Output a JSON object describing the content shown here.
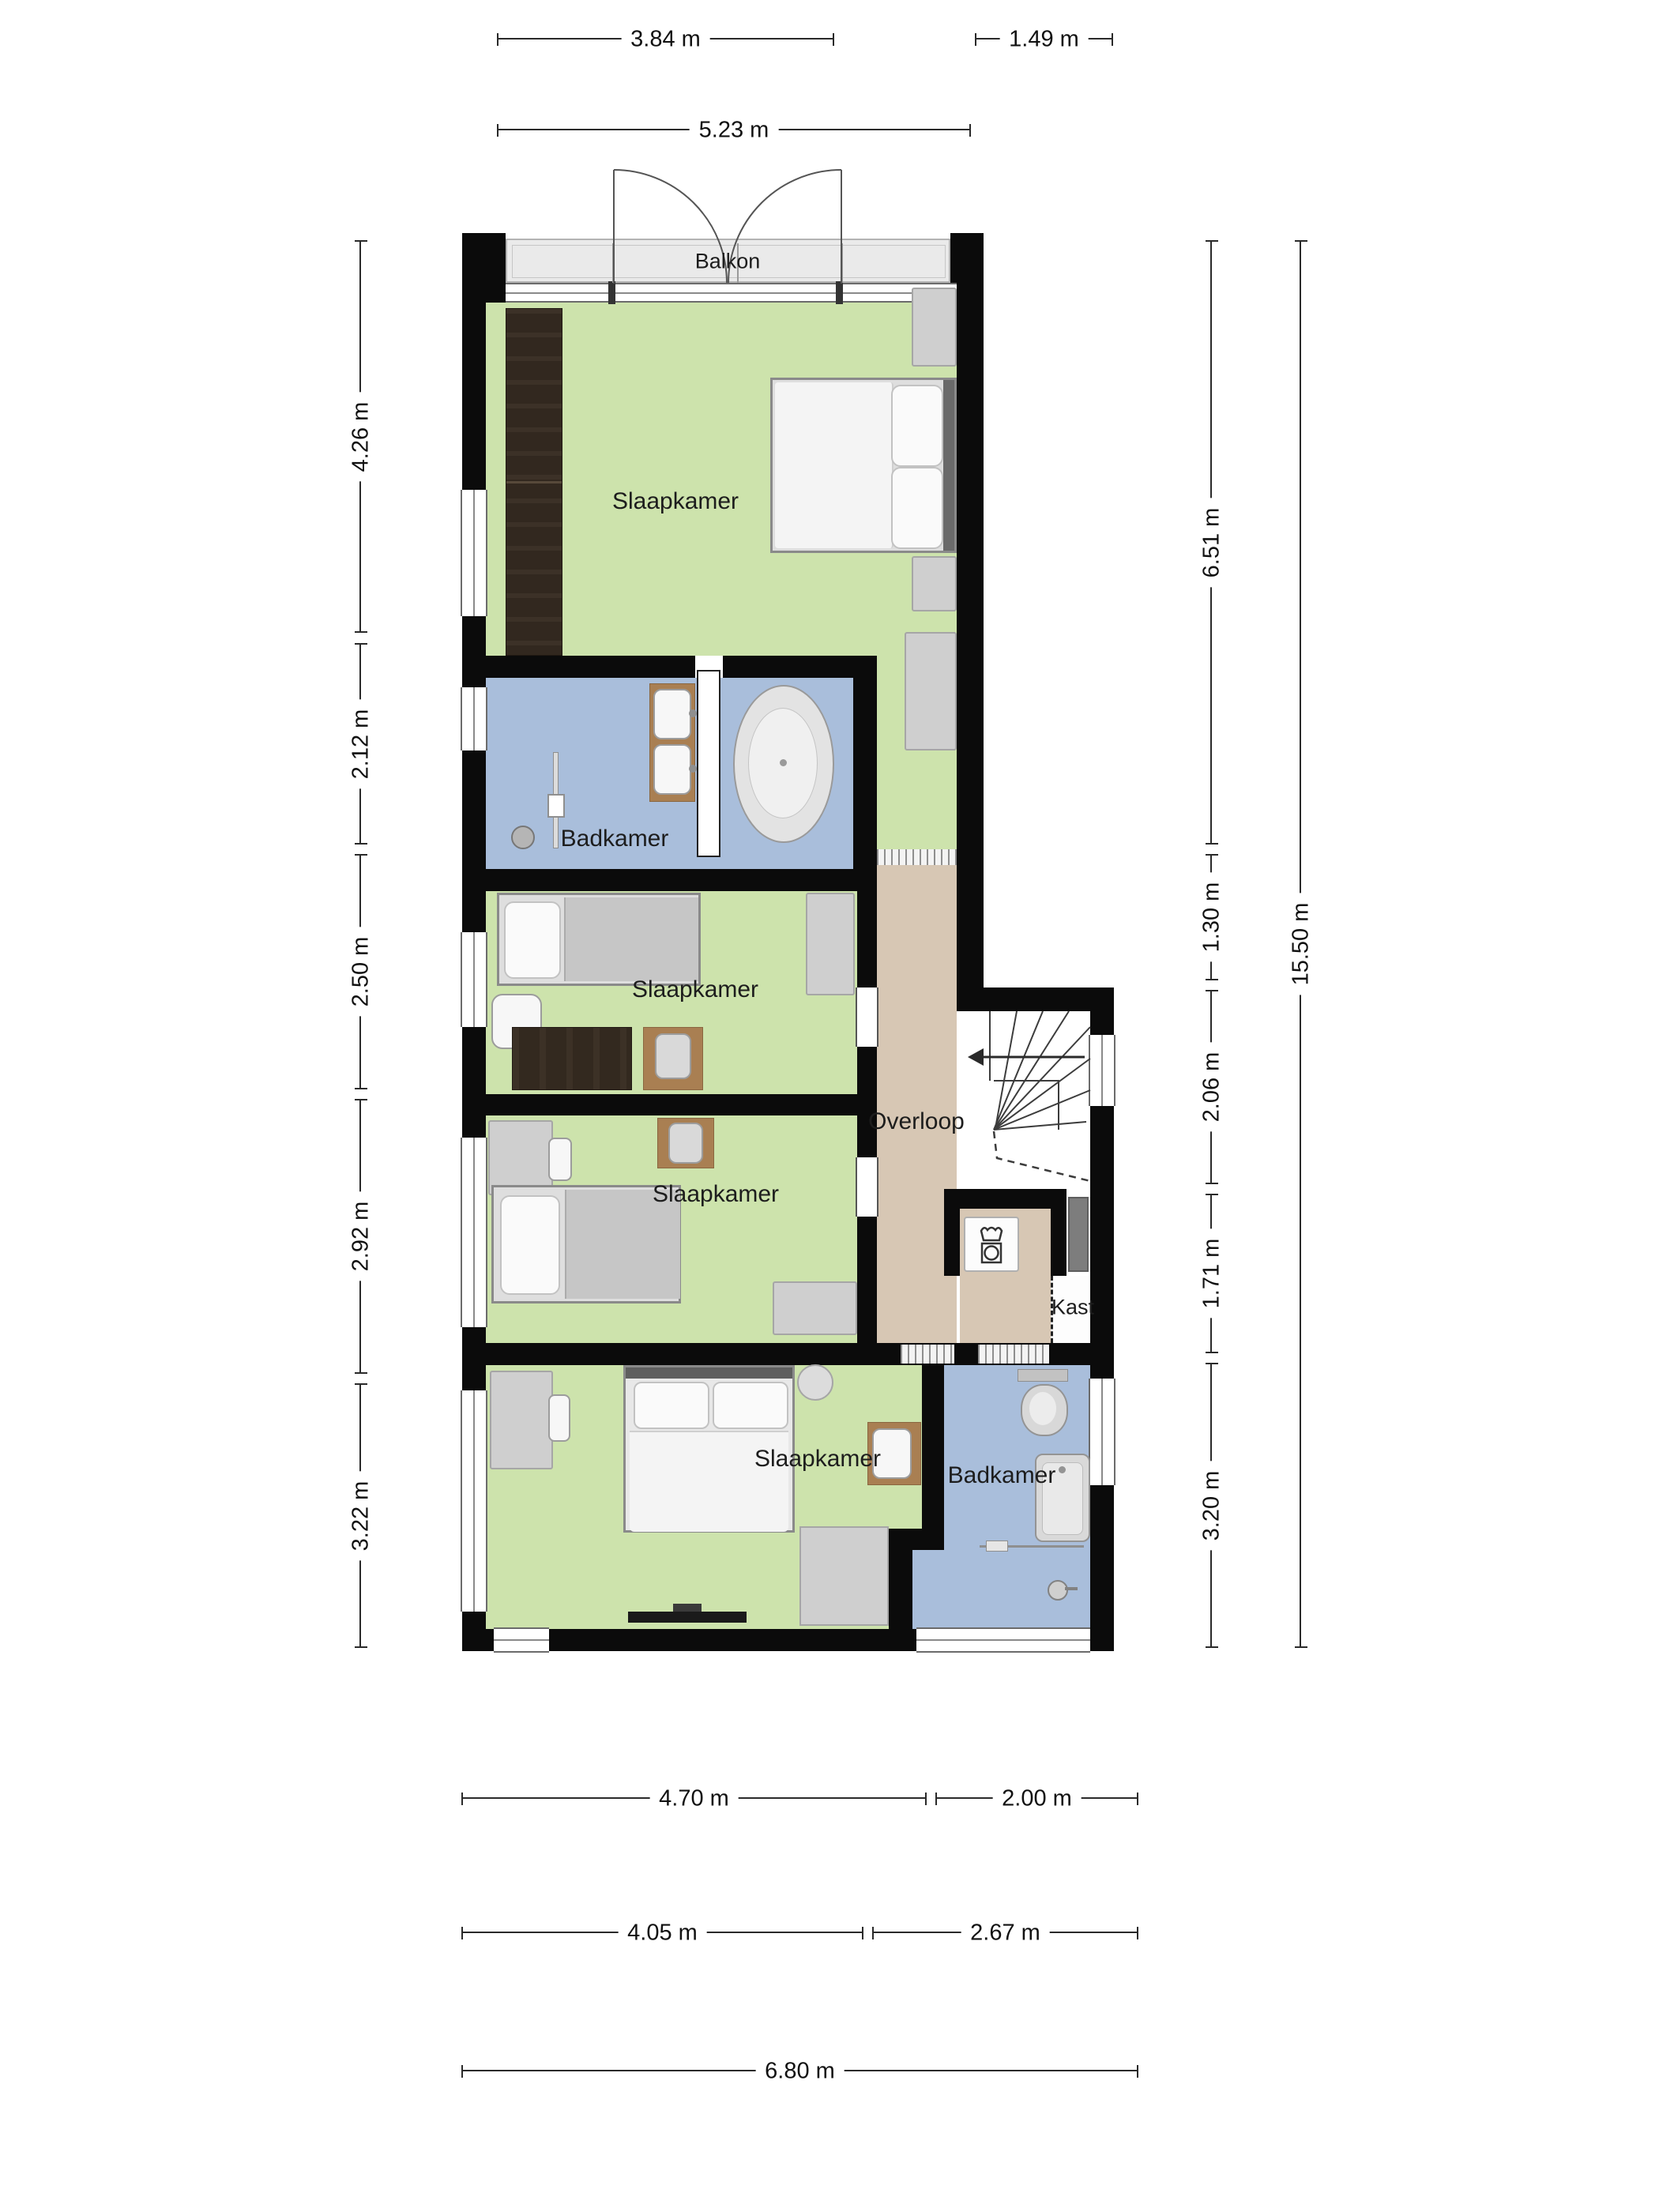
{
  "plan_type": "floor-plan",
  "labels": {
    "balkon": "Balkon",
    "slaapkamer_1": "Slaapkamer",
    "badkamer_1": "Badkamer",
    "slaapkamer_2": "Slaapkamer",
    "slaapkamer_3": "Slaapkamer",
    "slaapkamer_4": "Slaapkamer",
    "badkamer_2": "Badkamer",
    "overloop": "Overloop",
    "kast": "Kast"
  },
  "dimensions": {
    "top_row_1": [
      "3.84 m",
      "1.49 m"
    ],
    "top_row_2": [
      "5.23 m"
    ],
    "left": [
      "4.26 m",
      "2.12 m",
      "2.50 m",
      "2.92 m",
      "3.22 m"
    ],
    "right_inner": [
      "6.51 m",
      "1.30 m",
      "2.06 m",
      "1.71 m",
      "3.20 m"
    ],
    "right_outer": [
      "15.50 m"
    ],
    "bottom_row_1": [
      "4.70 m",
      "2.00 m"
    ],
    "bottom_row_2": [
      "4.05 m",
      "2.67 m"
    ],
    "bottom_row_3": [
      "6.80 m"
    ]
  },
  "colors": {
    "bedroom_floor": "#cde3ac",
    "bathroom_floor": "#a9bedb",
    "hall_floor": "#d7c7b4",
    "balcony_floor": "#eaeaea",
    "wall": "#0b0b0b",
    "wardrobe": "#32281f",
    "furniture_gray": "#cfcfcf"
  },
  "icons": [
    "double-bed-icon",
    "single-bed-icon",
    "bathtub-oval-icon",
    "bathtub-rect-icon",
    "toilet-icon",
    "sink-icon",
    "shower-icon",
    "washing-machine-icon",
    "staircase-icon",
    "door-swing-icon",
    "window-icon",
    "wardrobe-icon",
    "desk-icon",
    "chair-icon",
    "tv-icon",
    "towel-rail-icon",
    "faucet-icon"
  ]
}
